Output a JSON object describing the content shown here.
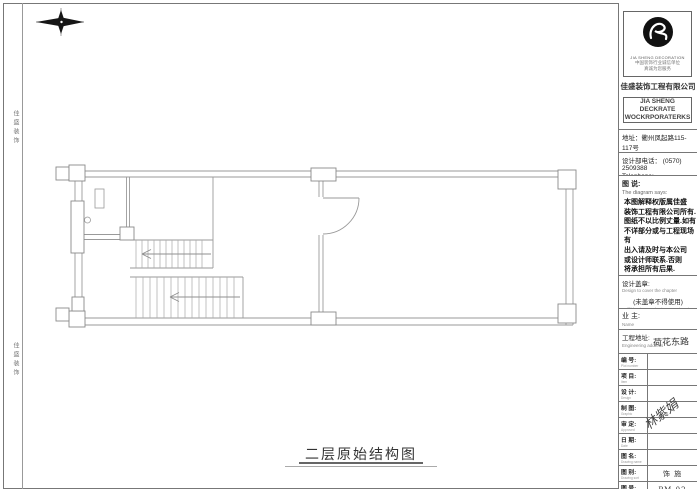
{
  "plan": {
    "title": "二层原始结构图"
  },
  "side_strip": {
    "top_label": "佳盛装饰",
    "bottom_label": "佳盛装饰"
  },
  "title_block": {
    "logo_caption": "JIA SHENG DECORATION",
    "logo_sub1": "中国装饰行业诚信单位",
    "logo_sub2": "真诚为您服务",
    "company_cn": "佳盛装饰工程有限公司",
    "company_en_line1": "JIA SHENG DECKRATE",
    "company_en_line2": "WOCKRPORATERKS",
    "address_cn": "地址：衢州凤起路115-117号",
    "address_en": "Address Feng Qi Road No.115-117",
    "phone_cn": "设计部电话： (0570) 2509388",
    "phone_en": "Telephone:",
    "notes_title_cn": "图 说:",
    "notes_title_en": "The diagram says:",
    "notes_lines": [
      "本图解释权版属佳盛",
      "装饰工程有限公司所有.",
      "图纸不以比例丈量.如有",
      "不详部分或与工程现场有",
      "出入请及时与本公司",
      "或设计师联系.否则",
      "将承担所有后果."
    ],
    "stamp_label_cn": "设计盖章:",
    "stamp_label_en": "Design to cover the chapter",
    "stamp_note_cn": "(未盖章不得使用)",
    "stamp_note_en": "(Did not cover chapter can not use)",
    "owner_label_cn": "业 主:",
    "owner_label_en": "Name",
    "site_label_cn": "工程地址:",
    "site_label_en": "Engineering address",
    "site_value": "荷花东路",
    "watermark": "林紫娟",
    "rows": [
      {
        "cn": "编 号:",
        "en": "Plot number",
        "value": ""
      },
      {
        "cn": "项 目:",
        "en": "Item",
        "value": ""
      },
      {
        "cn": "设 计:",
        "en": "Design",
        "value": ""
      },
      {
        "cn": "制 图:",
        "en": "Graphic",
        "value": ""
      },
      {
        "cn": "审 定:",
        "en": "Approved",
        "value": ""
      },
      {
        "cn": "日 期:",
        "en": "Date",
        "value": ""
      },
      {
        "cn": "图 名:",
        "en": "Drawing name",
        "value": ""
      },
      {
        "cn": "图 别:",
        "en": "Drawing sort",
        "value": "饰 施"
      },
      {
        "cn": "图 号:",
        "en": "Drawing number",
        "value": "PM-02"
      }
    ]
  }
}
